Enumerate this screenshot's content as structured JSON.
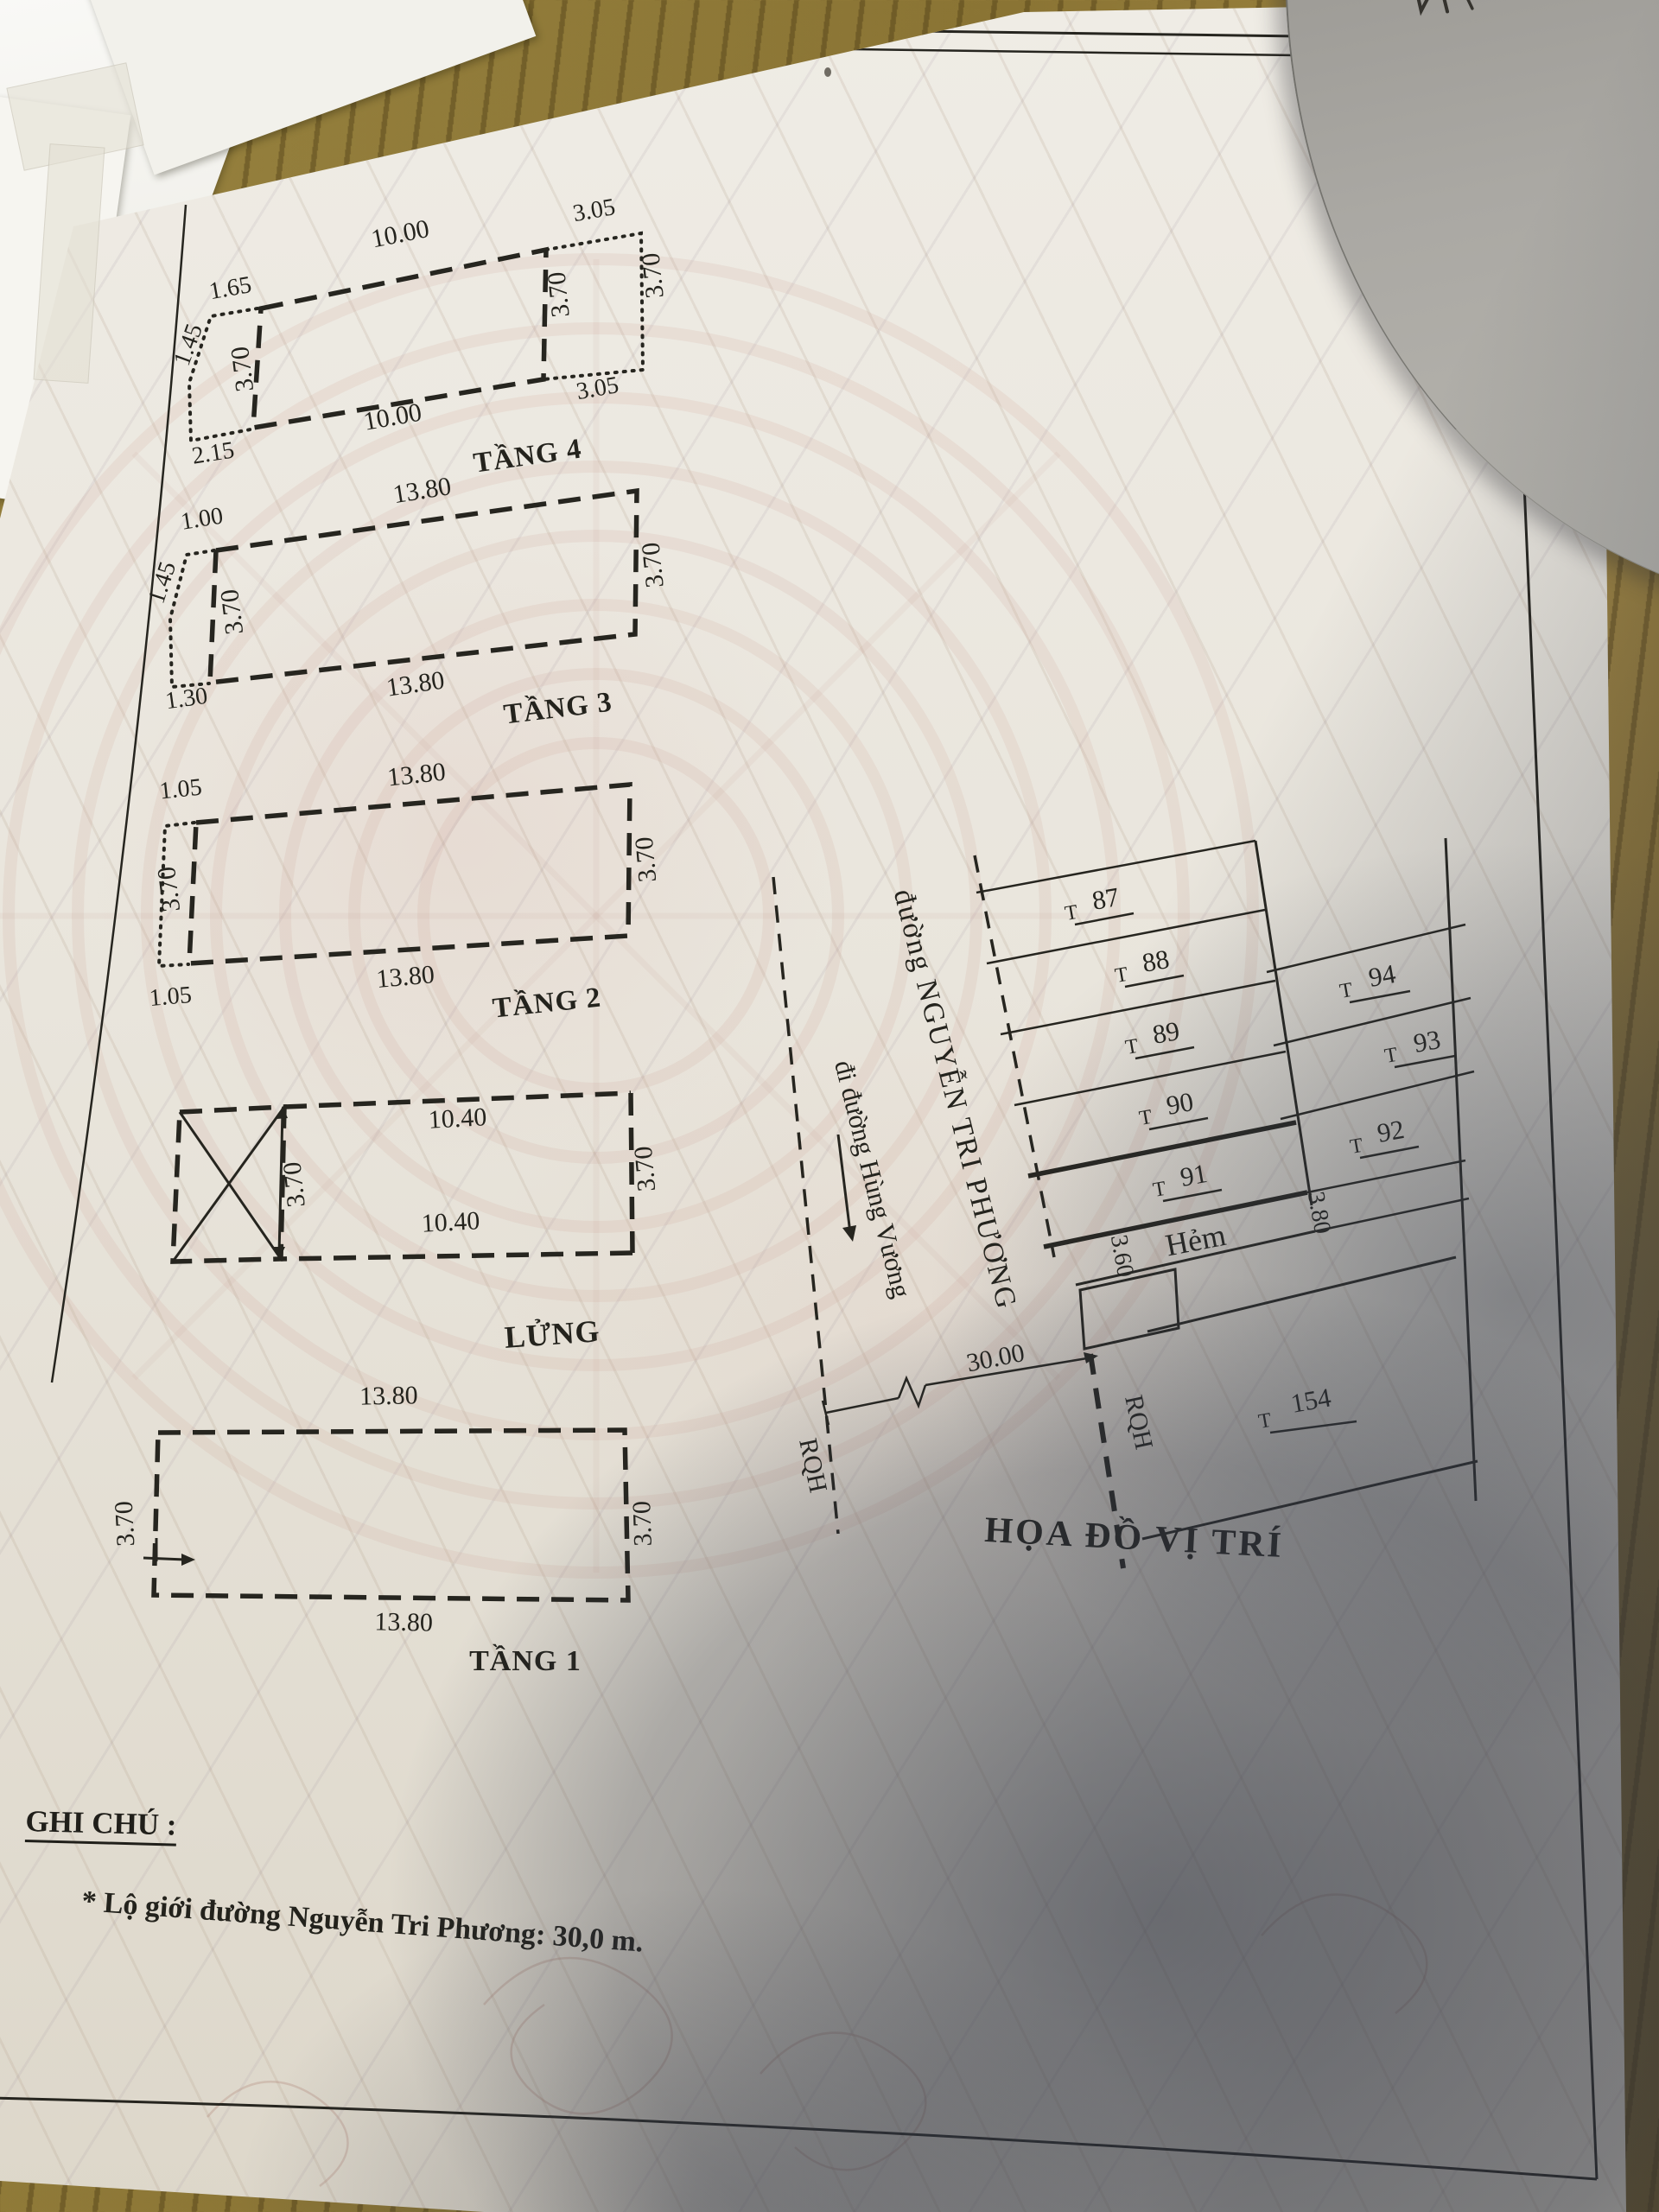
{
  "photo": {
    "desk_color": "#8a7434",
    "paper_color": "#e9e5dc",
    "ink_color": "#24231d",
    "shadow_color": "#39404f",
    "watermark_color": "#d9b8ac",
    "overlapping_paper_color": "#a9a7a2"
  },
  "page": {
    "header_title": "Mục III. Sơ đồ nhà ở, đất ở",
    "notes_heading": "GHI CHÚ :",
    "note_1": "* Lộ giới đường Nguyễn Tri Phương: 30,0 m."
  },
  "floor_plans": {
    "tang4": {
      "label": "TẦNG 4",
      "dim_top": "10.00",
      "dim_bottom": "10.00",
      "dim_left": "3.70",
      "dim_right_inner": "3.70",
      "dim_right_outer": "3.70",
      "ext_left_top": "1.65",
      "ext_left_side": "1.45",
      "ext_left_bottom": "2.15",
      "ext_right_top": "3.05",
      "ext_right_bottom": "3.05"
    },
    "tang3": {
      "label": "TẦNG 3",
      "dim_top": "13.80",
      "dim_bottom": "13.80",
      "dim_left": "3.70",
      "dim_right": "3.70",
      "ext_left_top": "1.00",
      "ext_left_side": "1.45",
      "ext_left_bottom": "1.30"
    },
    "tang2": {
      "label": "TẦNG 2",
      "dim_top": "13.80",
      "dim_bottom": "13.80",
      "dim_left": "3.70",
      "dim_right": "3.70",
      "ext_left_top": "1.05",
      "ext_left_bottom": "1.05"
    },
    "lung": {
      "label": "LỬNG",
      "dim_top": "10.40",
      "dim_bottom": "10.40",
      "dim_mid": "3.70",
      "dim_right": "3.70"
    },
    "tang1": {
      "label": "TẦNG 1",
      "dim_top": "13.80",
      "dim_bottom": "13.80",
      "dim_left": "3.70",
      "dim_right": "3.70"
    }
  },
  "site_map": {
    "title": "HỌA ĐỒ VỊ TRÍ",
    "street_name": "đường NGUYỄN TRI PHƯƠNG",
    "street_direction": "đi đường Hùng Vương",
    "parcel_prefix": "T",
    "lots_left": [
      "87",
      "88",
      "89",
      "90",
      "91"
    ],
    "lots_right": [
      "94",
      "93",
      "92"
    ],
    "lot_far": "154",
    "alley_label": "Hẻm",
    "alley_width_left": "3.60",
    "alley_width_right": "3.80",
    "road_width": "30.00",
    "planning_label_1": "RQH",
    "planning_label_2": "RQH",
    "planning_label_3": "RQH"
  }
}
